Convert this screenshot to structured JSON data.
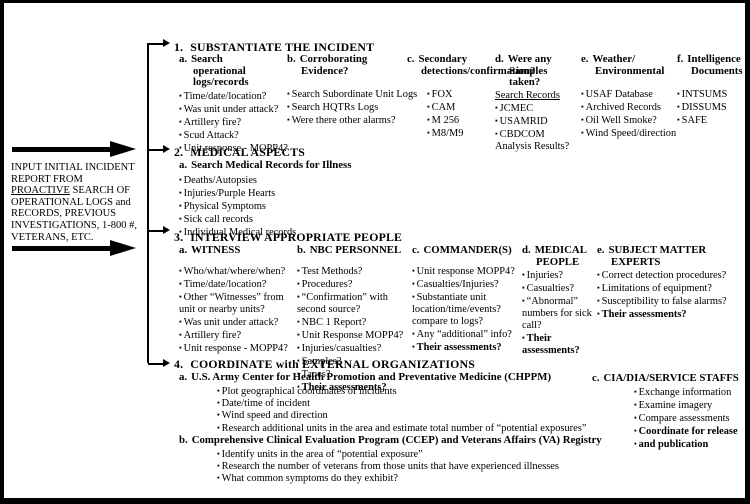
{
  "colors": {
    "ink": "#000000",
    "paper": "#ffffff"
  },
  "icons": {
    "bullet_glyph": "▪",
    "input_arrow": "right-arrow",
    "branch_arrow": "right-arrow"
  },
  "note": {
    "lines": [
      {
        "text": "INPUT INITIAL INCIDENT"
      },
      {
        "text": "REPORT FROM"
      },
      {
        "text": "PROACTIVE SEARCH OF",
        "underline": "PROACTIVE"
      },
      {
        "text": "OPERATIONAL LOGS and"
      },
      {
        "text": "RECORDS, PREVIOUS"
      },
      {
        "text": "INVESTIGATIONS, 1-800 #,"
      },
      {
        "text": "VETERANS, ETC."
      }
    ]
  },
  "sections": [
    {
      "id": "s1",
      "number": "1.",
      "title": "SUBSTANTIATE THE INCIDENT",
      "columns": [
        {
          "key": "a",
          "label": "a.",
          "heading": "Search operational logs/records",
          "items": [
            {
              "t": "Time/date/location?"
            },
            {
              "t": "Was unit under attack?"
            },
            {
              "t": "Artillery fire?"
            },
            {
              "t": "Scud Attack?"
            },
            {
              "t": "Unit response - MOPP4?"
            }
          ]
        },
        {
          "key": "b",
          "label": "b.",
          "heading": "Corroborating Evidence?",
          "items": [
            {
              "t": "Search Subordinate Unit Logs"
            },
            {
              "t": "Search HQTRs Logs"
            },
            {
              "t": "Were there other alarms?"
            }
          ]
        },
        {
          "key": "c",
          "label": "c.",
          "heading": "Secondary detections/confirmation?",
          "items": [
            {
              "t": "FOX"
            },
            {
              "t": "CAM"
            },
            {
              "t": "M 256"
            },
            {
              "t": "M8/M9"
            }
          ]
        },
        {
          "key": "d",
          "label": "d.",
          "heading": "Were any Samples taken?",
          "items": [
            {
              "t": "Search Records",
              "plain": true,
              "ul": true
            },
            {
              "t": "JCMEC"
            },
            {
              "t": "USAMRID"
            },
            {
              "t": "CBDCOM"
            },
            {
              "t": "Analysis Results?",
              "plain": true
            }
          ]
        },
        {
          "key": "e",
          "label": "e.",
          "heading": "Weather/ Environmental",
          "items": [
            {
              "t": "USAF Database"
            },
            {
              "t": "Archived Records"
            },
            {
              "t": "Oil Well Smoke?"
            },
            {
              "t": "Wind Speed/direction"
            }
          ]
        },
        {
          "key": "f",
          "label": "f.",
          "heading": "Intelligence Documents",
          "items": [
            {
              "t": "INTSUMS"
            },
            {
              "t": "DISSUMS"
            },
            {
              "t": "SAFE"
            }
          ]
        }
      ]
    },
    {
      "id": "s2",
      "number": "2.",
      "title": "MEDICAL ASPECTS",
      "columns": [
        {
          "key": "a",
          "label": "a.",
          "heading": "Search Medical Records for Illness",
          "items": [
            {
              "t": "Deaths/Autopsies"
            },
            {
              "t": "Injuries/Purple Hearts"
            },
            {
              "t": "Physical Symptoms"
            },
            {
              "t": "Sick call records"
            },
            {
              "t": "Individual Medical records"
            }
          ]
        }
      ]
    },
    {
      "id": "s3",
      "number": "3.",
      "title": "INTERVIEW APPROPRIATE PEOPLE",
      "columns": [
        {
          "key": "a",
          "label": "a.",
          "heading": "WITNESS",
          "items": [
            {
              "t": "Who/what/where/when?"
            },
            {
              "t": "Time/date/location?"
            },
            {
              "t": "Other “Witnesses” from unit or nearby units?"
            },
            {
              "t": "Was unit under attack?"
            },
            {
              "t": "Artillery fire?"
            },
            {
              "t": "Unit response - MOPP4?"
            }
          ]
        },
        {
          "key": "b",
          "label": "b.",
          "heading": "NBC PERSONNEL",
          "items": [
            {
              "t": "Test Methods?"
            },
            {
              "t": "Procedures?"
            },
            {
              "t": "“Confirmation” with second source?"
            },
            {
              "t": "NBC 1 Report?"
            },
            {
              "t": "Unit Response MOPP4?"
            },
            {
              "t": "Injuries/casualties?"
            },
            {
              "t": "Samples?"
            },
            {
              "t": "Tapes?"
            },
            {
              "t": "Their assessments?",
              "bold": true
            }
          ]
        },
        {
          "key": "c",
          "label": "c.",
          "heading": "COMMANDER(S)",
          "items": [
            {
              "t": "Unit response MOPP4?"
            },
            {
              "t": "Casualties/Injuries?"
            },
            {
              "t": "Substantiate unit location/time/events? compare to logs?"
            },
            {
              "t": "Any “additional” info?"
            },
            {
              "t": "Their assessments?",
              "bold": true
            }
          ]
        },
        {
          "key": "d",
          "label": "d.",
          "heading": "MEDICAL PEOPLE",
          "items": [
            {
              "t": "Injuries?"
            },
            {
              "t": "Casualties?"
            },
            {
              "t": "“Abnormal” numbers for sick call?"
            },
            {
              "t": "Their assessments?",
              "bold": true
            }
          ]
        },
        {
          "key": "e",
          "label": "e.",
          "heading": "SUBJECT MATTER EXPERTS",
          "items": [
            {
              "t": "Correct detection procedures?"
            },
            {
              "t": "Limitations of equipment?"
            },
            {
              "t": "Susceptibility to false alarms?"
            },
            {
              "t": "Their assessments?",
              "bold": true
            }
          ]
        }
      ]
    },
    {
      "id": "s4",
      "number": "4.",
      "title": "COORDINATE with EXTERNAL ORGANIZATIONS",
      "columns": [
        {
          "key": "main",
          "blocks": [
            {
              "label": "a.",
              "heading": "U.S. Army Center for Health Promotion and Preventative Medicine (CHPPM)",
              "items": [
                {
                  "t": "Plot geographical coordinates of incidents"
                },
                {
                  "t": "Date/time of incident"
                },
                {
                  "t": "Wind speed and direction"
                },
                {
                  "t": "Research additional units in the area and estimate total number of “potential exposures”"
                }
              ]
            },
            {
              "label": "b.",
              "heading": "Comprehensive Clinical Evaluation Program (CCEP) and Veterans Affairs (VA) Registry",
              "items": [
                {
                  "t": "Identify units in the area of “potential exposure”"
                },
                {
                  "t": "Research the number of veterans from those units that have experienced illnesses"
                },
                {
                  "t": "What common symptoms do they exhibit?"
                }
              ]
            }
          ]
        },
        {
          "key": "c",
          "label": "c.",
          "heading": "CIA/DIA/SERVICE  STAFFS",
          "items": [
            {
              "t": "Exchange information"
            },
            {
              "t": "Examine imagery"
            },
            {
              "t": "Compare assessments"
            },
            {
              "t": "Coordinate for release",
              "bold": true
            },
            {
              "t": "and publication",
              "bold": true
            }
          ]
        }
      ]
    }
  ]
}
